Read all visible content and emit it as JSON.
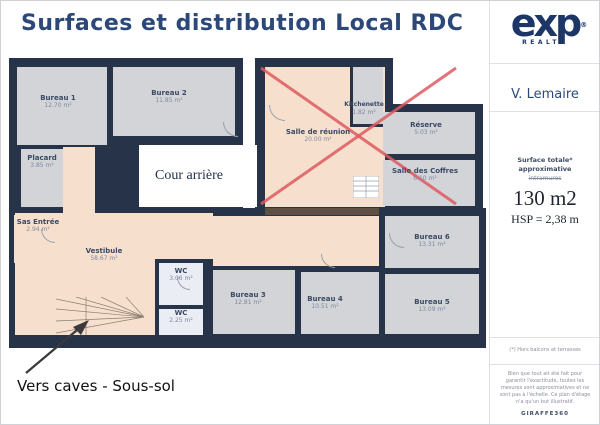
{
  "title": "Surfaces et distribution Local  RDC",
  "logo": {
    "brand": "exp",
    "registered": "®",
    "subtitle": "REALTY"
  },
  "agent_name": "V. Lemaire",
  "surface_panel": {
    "line1": "Surface totale*",
    "line2": "approximative",
    "struck": "intramuros",
    "value": "130 m2",
    "hsp": "HSP = 2,38 m"
  },
  "plan": {
    "courtyard_label": "Cour arrière",
    "basement_label": "Vers caves - Sous-sol",
    "rooms": [
      {
        "name": "Bureau 1",
        "area": "12.70 m²"
      },
      {
        "name": "Bureau 2",
        "area": "11.85 m²"
      },
      {
        "name": "Placard",
        "area": "3.85 m²"
      },
      {
        "name": "Sas Entrée",
        "area": "2.94 m²"
      },
      {
        "name": "Vestibule",
        "area": "58.67 m²"
      },
      {
        "name": "WC",
        "area": "3.06 m²"
      },
      {
        "name": "WC",
        "area": "2.25 m²"
      },
      {
        "name": "Bureau 3",
        "area": "12.81 m²"
      },
      {
        "name": "Bureau 4",
        "area": "10.51 m²"
      },
      {
        "name": "Bureau 5",
        "area": "13.09 m²"
      },
      {
        "name": "Bureau 6",
        "area": "13.31 m²"
      },
      {
        "name": "Salle de réunion",
        "area": "20.00 m²"
      },
      {
        "name": "Kitchenette",
        "area": "1.82 m²"
      },
      {
        "name": "Réserve",
        "area": "5.03 m²"
      },
      {
        "name": "Salle des Coffres",
        "area": "6.10 m²"
      }
    ]
  },
  "footnotes": {
    "measure_note": "(*) Hors balcons et terrasses",
    "disclaimer": "Bien que tout ait été fait pour garantir l'exactitude, toutes les mesures sont approximatives et ne sont pas à l'échelle. Ce plan d'étage n'a qu'un but illustratif.",
    "brand": "GIRAFFE360"
  },
  "colors": {
    "wall": "#263349",
    "room_fill": "#d2d4d8",
    "circulation_fill": "#f7dfcd",
    "wc_fill": "#eaedf3",
    "cross": "#dd5a60",
    "brand_navy": "#1c3767",
    "title_text": "#2b4878"
  }
}
